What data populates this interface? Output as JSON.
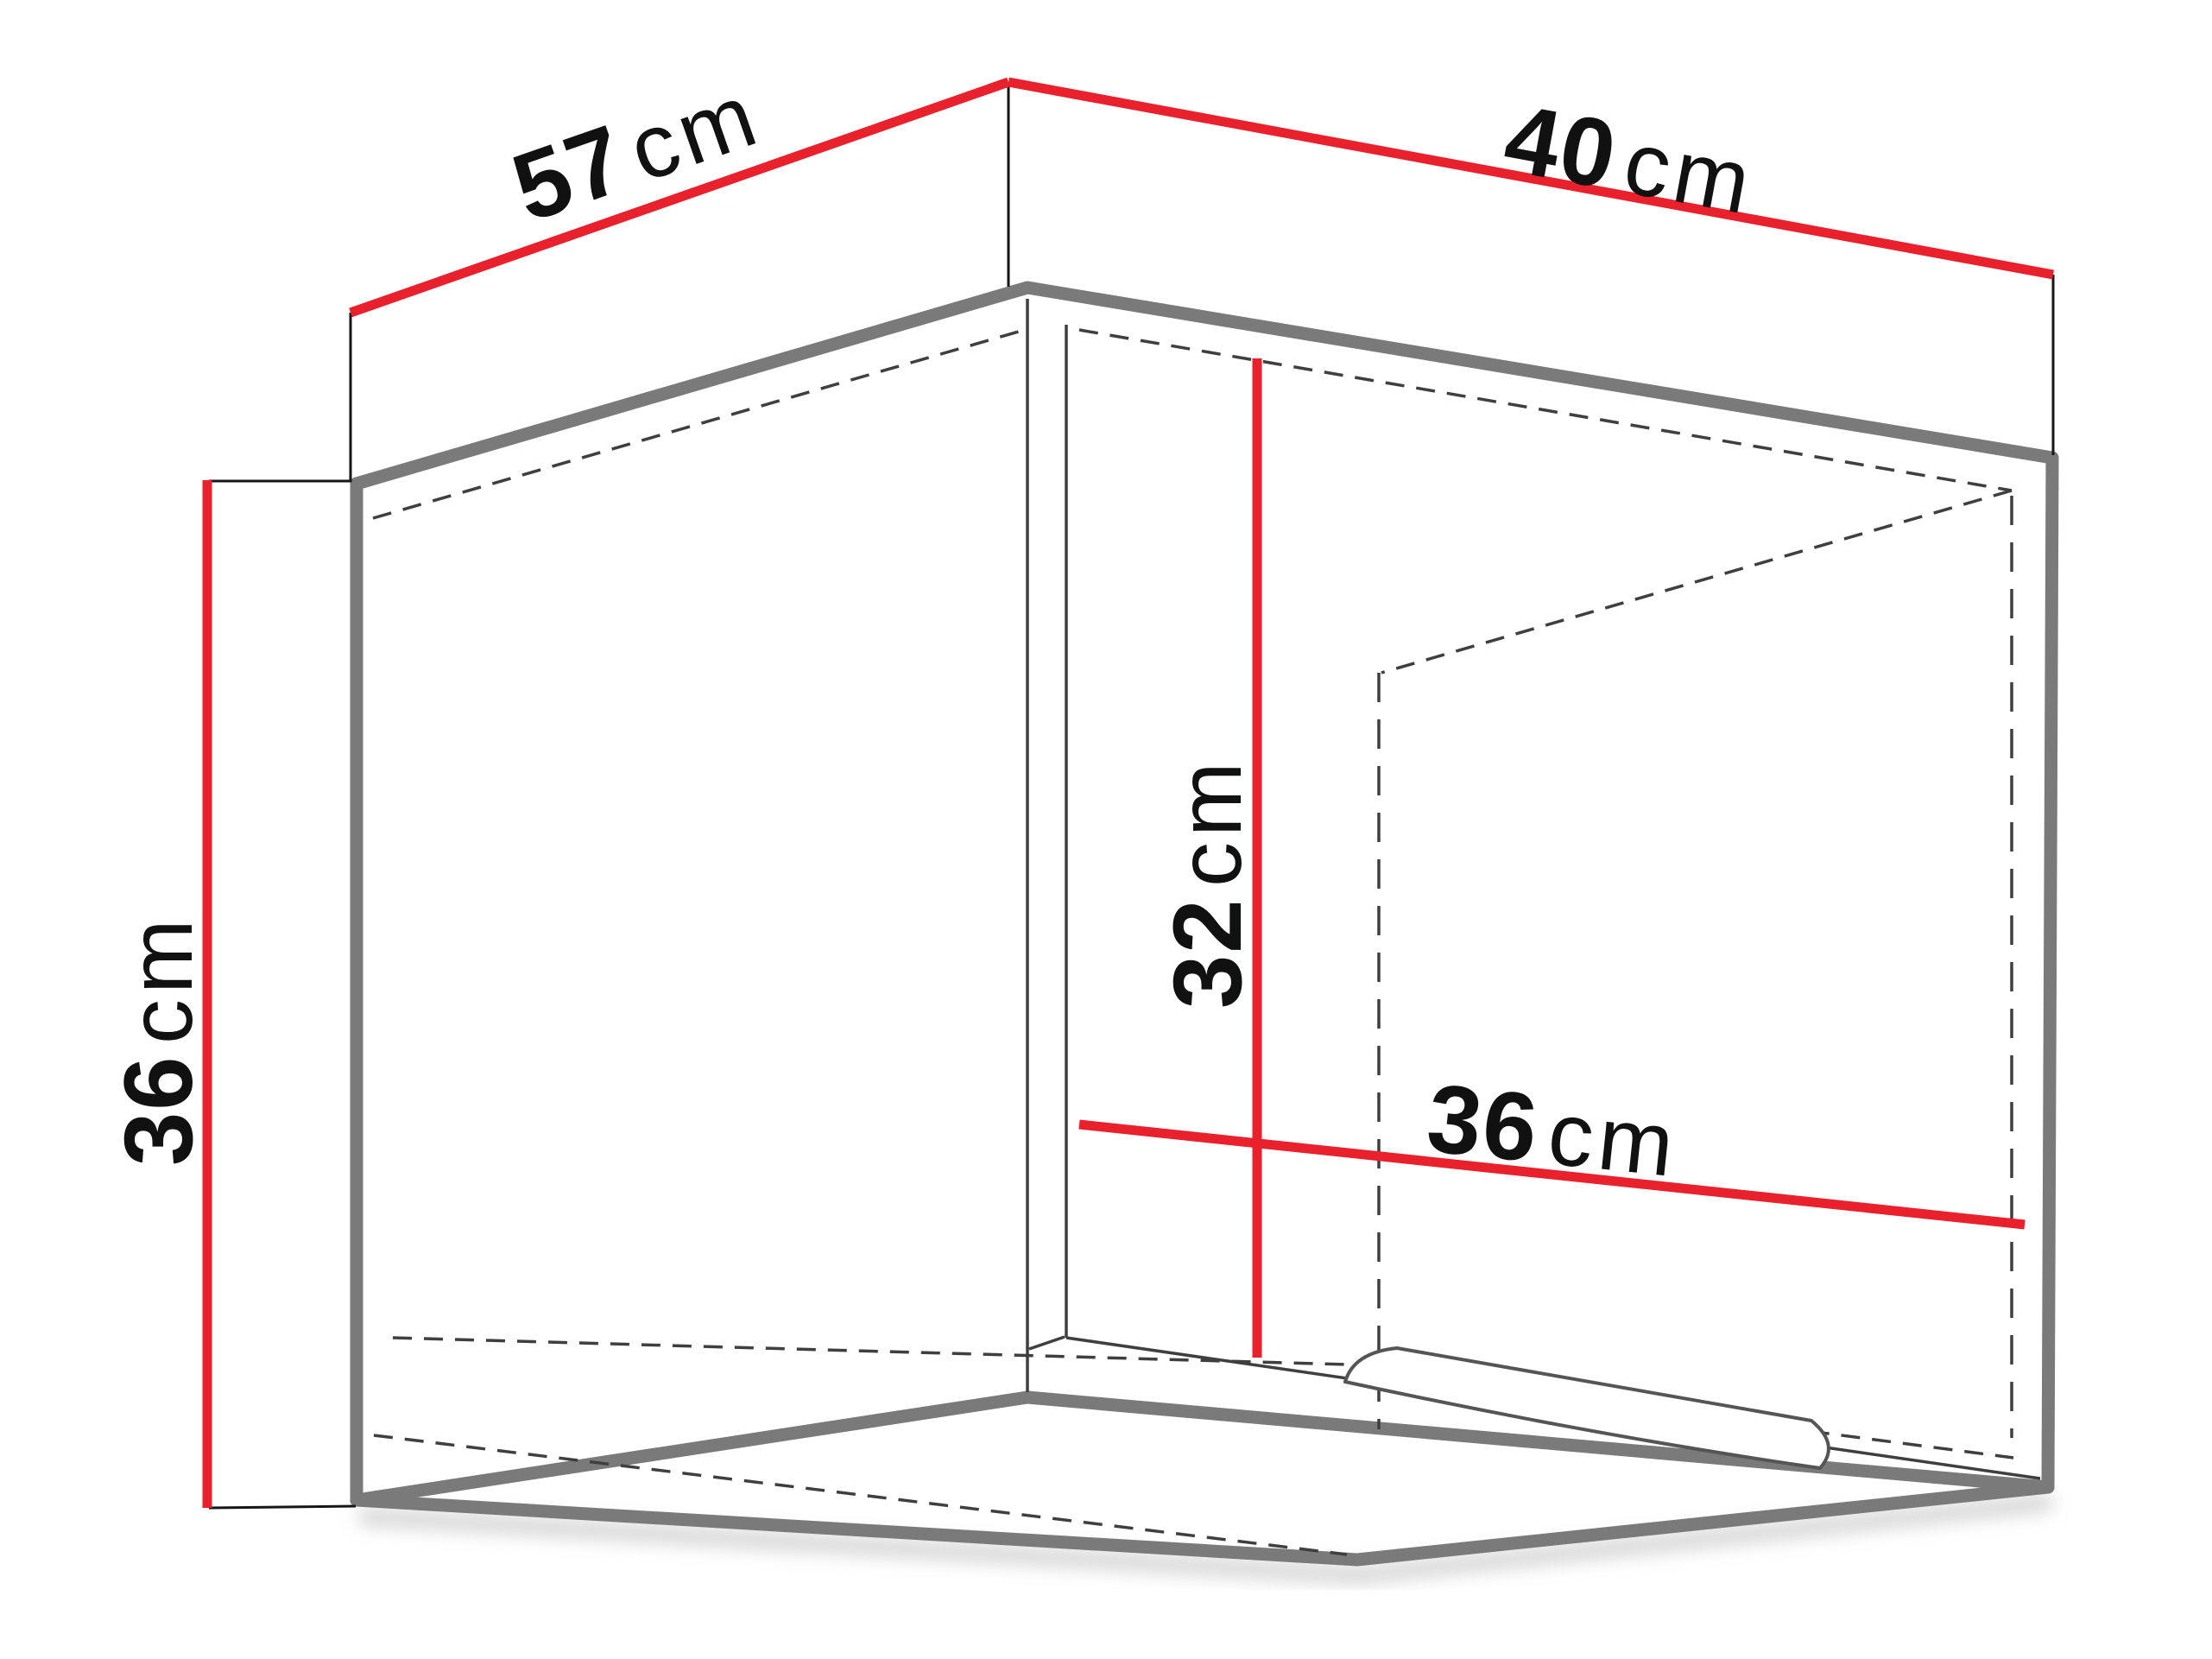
{
  "diagram_title": "Cabinet dimensions diagram",
  "colors": {
    "dimension_line": "#e8212c",
    "cabinet_outline": "#7a7a7a",
    "interior_line": "#3f3f3f",
    "label_text": "#111111",
    "background": "#ffffff"
  },
  "dimensions": {
    "top_left_width": {
      "value": "57",
      "unit": "cm"
    },
    "top_right_depth": {
      "value": "40",
      "unit": "cm"
    },
    "left_height": {
      "value": "36",
      "unit": "cm"
    },
    "interior_height": {
      "value": "32",
      "unit": "cm"
    },
    "interior_depth": {
      "value": "36",
      "unit": "cm"
    }
  }
}
